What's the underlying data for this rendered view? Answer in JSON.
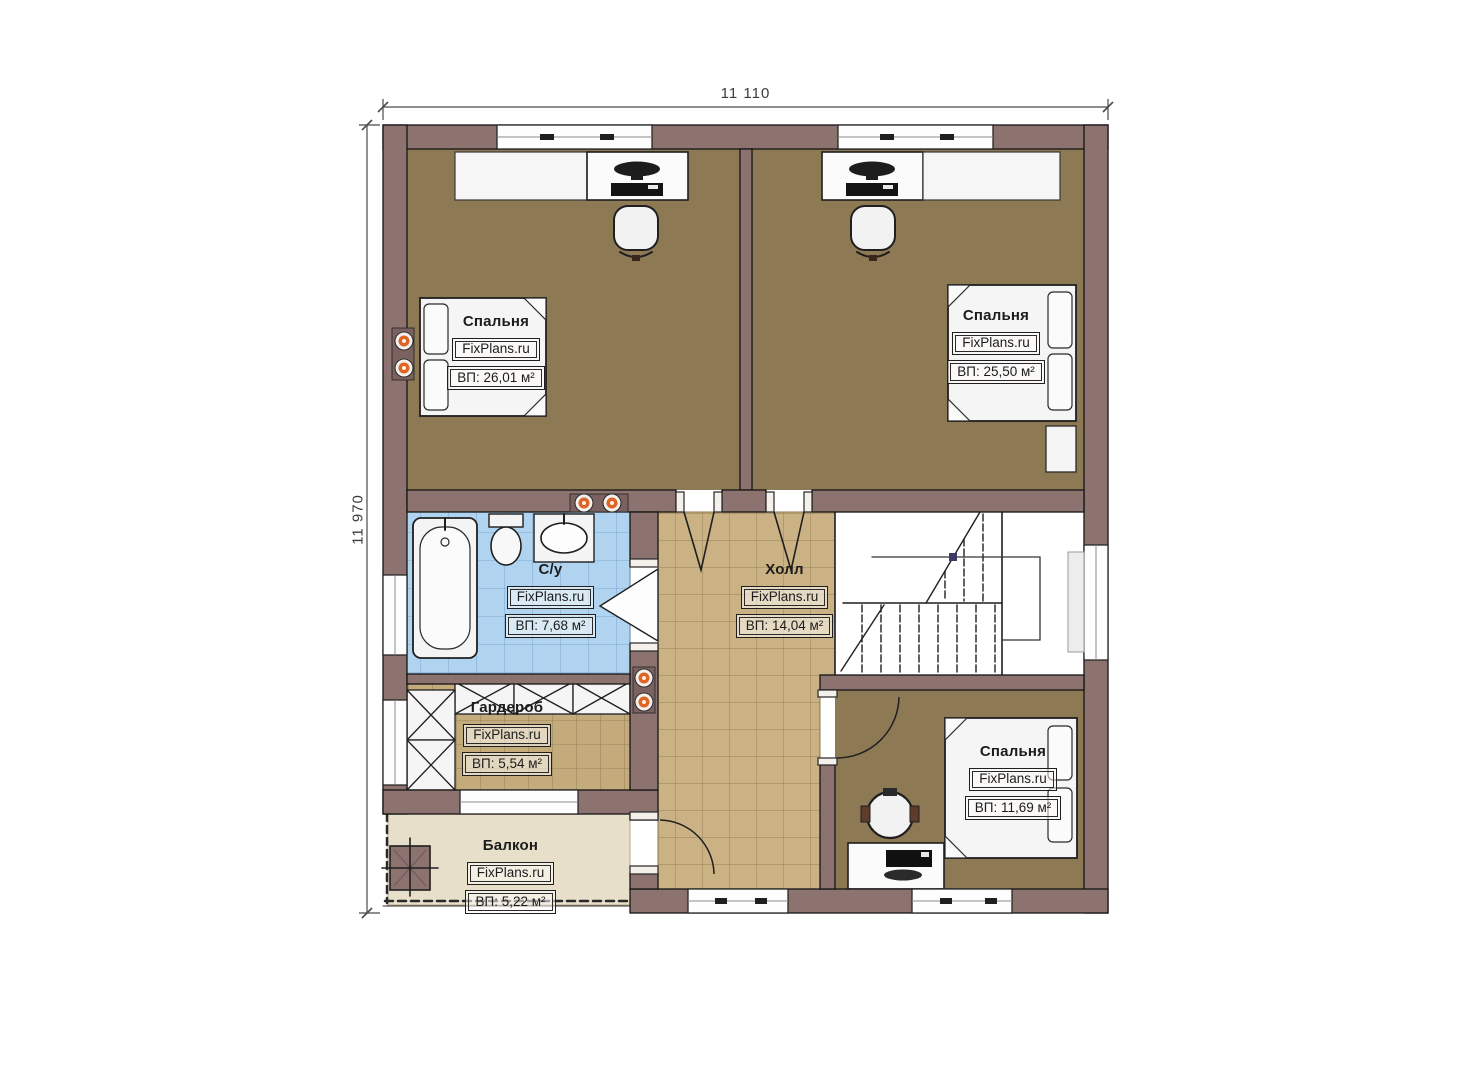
{
  "plan": {
    "dimensions": {
      "width": "11 110",
      "height": "11 970"
    },
    "rooms": [
      {
        "key": "bedroom-top-left",
        "name": "Спальня",
        "brand": "FixPlans.ru",
        "area": "ВП: 26,01 м²"
      },
      {
        "key": "bedroom-top-right",
        "name": "Спальня",
        "brand": "FixPlans.ru",
        "area": "ВП: 25,50 м²"
      },
      {
        "key": "bathroom",
        "name": "С/у",
        "brand": "FixPlans.ru",
        "area": "ВП: 7,68 м²"
      },
      {
        "key": "hall",
        "name": "Холл",
        "brand": "FixPlans.ru",
        "area": "ВП: 14,04 м²"
      },
      {
        "key": "wardrobe",
        "name": "Гардероб",
        "brand": "FixPlans.ru",
        "area": "ВП: 5,54 м²"
      },
      {
        "key": "bedroom-bottom-right",
        "name": "Спальня",
        "brand": "FixPlans.ru",
        "area": "ВП: 11,69 м²"
      },
      {
        "key": "balcony",
        "name": "Балкон",
        "brand": "FixPlans.ru",
        "area": "ВП: 5,22 м²"
      }
    ],
    "colors": {
      "wall": "#8c7370",
      "bedroom_floor": "#8e7955",
      "hall_floor": "#cbb284",
      "wardrobe_floor": "#c3ab7b",
      "bath_floor": "#b0d4f0",
      "balcony_floor": "#e8dfca",
      "spotlight_accent": "#dd6326"
    }
  }
}
